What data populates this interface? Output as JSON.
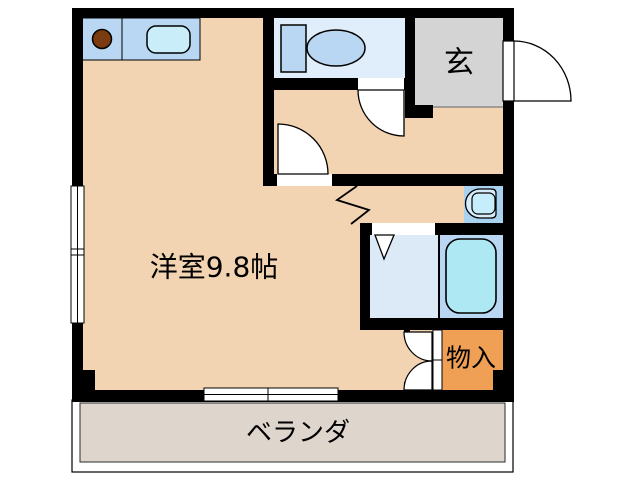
{
  "floorplan": {
    "labels": {
      "main_room": "洋室9.8帖",
      "entrance": "玄",
      "storage": "物入",
      "veranda": "ベランダ"
    },
    "colors": {
      "wall": "#000000",
      "floor": "#f2d3b2",
      "counter": "#b9d6f2",
      "kitchen_sink": "#c9eef9",
      "toilet_room": "#dfeefa",
      "toilet_fixture": "#b9d6f2",
      "entrance_floor": "#d4d4d4",
      "washroom": "#dce9f7",
      "bathroom": "#b9d6f2",
      "bathtub": "#aee8f3",
      "washbasin_area": "#a8d2f0",
      "washbasin_outer": "#d6ecfa",
      "washbasin": "#c5eefa",
      "storage": "#efa055",
      "veranda": "#ded5cd",
      "burner": "#7a3b10",
      "door": "#ffffff"
    },
    "fixtures": [
      "stove-burner",
      "kitchen-sink",
      "toilet",
      "washbasin",
      "bathtub"
    ]
  }
}
